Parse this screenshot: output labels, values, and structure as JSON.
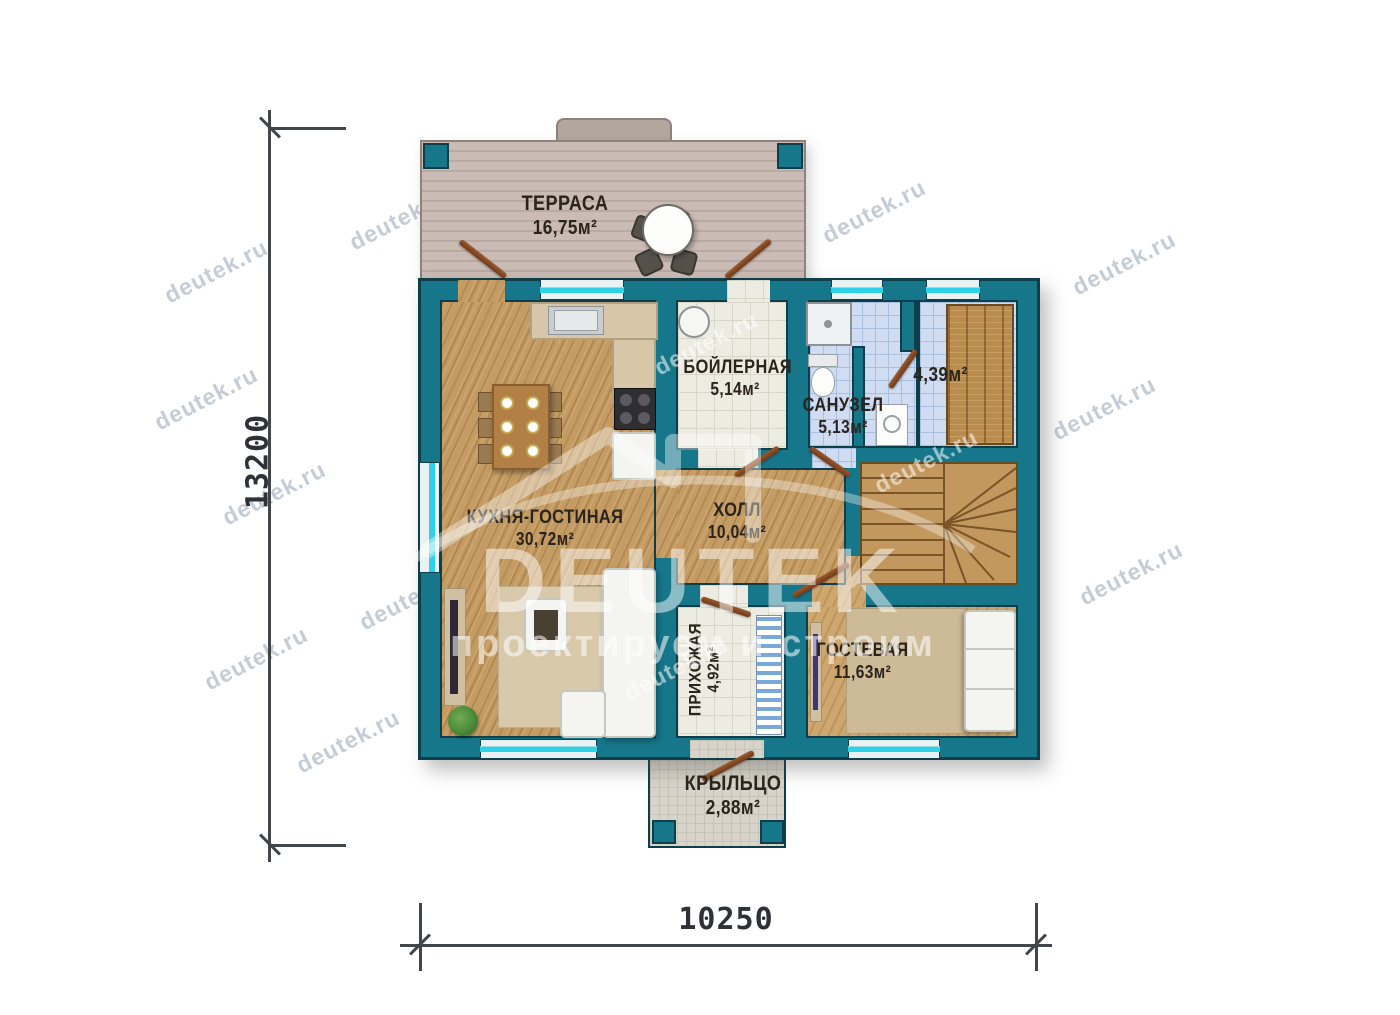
{
  "watermark": {
    "text": "deutek.ru"
  },
  "logo": {
    "name": "DEUTEK",
    "tagline": "проектируем и строим"
  },
  "dimensions": {
    "height_mm": "13200",
    "width_mm": "10250"
  },
  "rooms": [
    {
      "id": "terrace",
      "name": "ТЕРРАСА",
      "area": "16,75м²"
    },
    {
      "id": "kitchen",
      "name": "КУХНЯ-ГОСТИНАЯ",
      "area": "30,72м²"
    },
    {
      "id": "boiler",
      "name": "БОЙЛЕРНАЯ",
      "area": "5,14м²"
    },
    {
      "id": "bath",
      "name": "САНУЗЕЛ",
      "area": "5,13м²"
    },
    {
      "id": "wardrobe",
      "name": "",
      "area": "4,39м²"
    },
    {
      "id": "hall",
      "name": "ХОЛЛ",
      "area": "10,04м²"
    },
    {
      "id": "entry",
      "name": "ПРИХОЖАЯ",
      "area": "4,92м²"
    },
    {
      "id": "guest",
      "name": "ГОСТЕВАЯ",
      "area": "11,63м²"
    },
    {
      "id": "porch",
      "name": "КРЫЛЬЦО",
      "area": "2,88м²"
    }
  ],
  "colors": {
    "wall": "#16768a",
    "wall_outline": "#0e3e4a",
    "wood_floor": "#c49b62",
    "white_tile": "#edece3",
    "blue_tile": "#cfdcf1",
    "terrace_deck": "#c8b8b1",
    "porch_floor": "#d8d4ca",
    "window_glass": "#2ed1e6",
    "door": "#8a4e26",
    "dimension_line": "#41464b",
    "label_text": "#2a241d",
    "watermark": "#9fadbb"
  }
}
